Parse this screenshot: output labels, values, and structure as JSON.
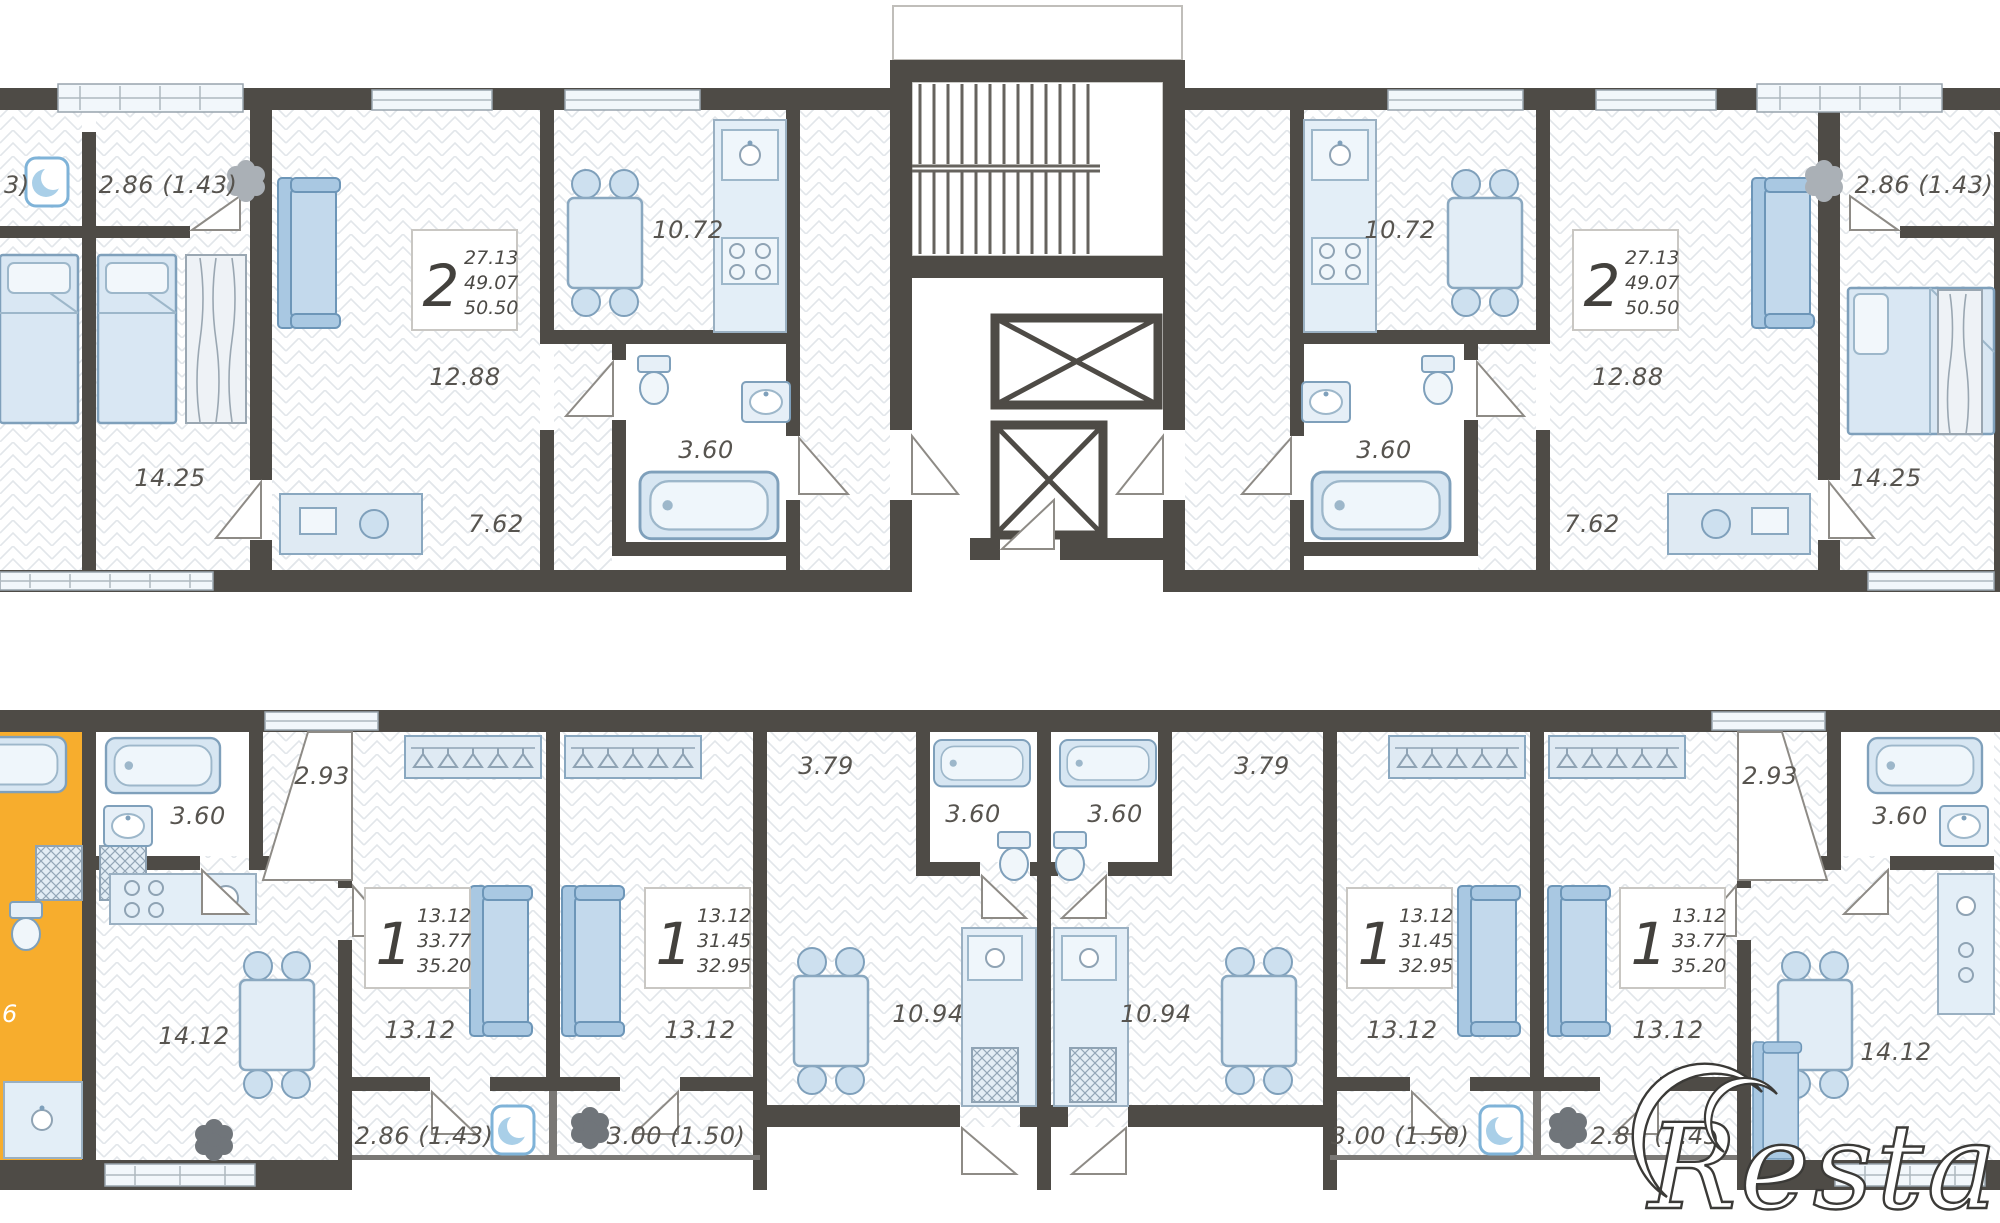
{
  "watermark": "Restate",
  "colors": {
    "wall": "#4e4b46",
    "highlight_orange": "#f7ad2d",
    "furniture_blue": "#d7e6f2",
    "label_gray": "#57544f"
  },
  "upper": {
    "edge_balcony_partial": "3)",
    "left": {
      "type": "2",
      "area_living": "27.13",
      "area_main": "49.07",
      "area_total": "50.50",
      "balcony": "2.86 (1.43)",
      "bedroom": "14.25",
      "living": "12.88",
      "kitchen": "10.72",
      "bath": "3.60",
      "hall": "7.62"
    },
    "right": {
      "type": "2",
      "area_living": "27.13",
      "area_main": "49.07",
      "area_total": "50.50",
      "balcony": "2.86 (1.43)",
      "bedroom": "14.25",
      "living": "12.88",
      "kitchen": "10.72",
      "bath": "3.60",
      "hall": "7.62"
    }
  },
  "lower": {
    "highlighted_partial": "6",
    "left_corner": {
      "bath": "3.60",
      "loggia": "2.93",
      "kitchen_living": "14.12"
    },
    "one_room_a_left": {
      "type": "1",
      "area_living": "13.12",
      "area_main": "33.77",
      "area_total": "35.20",
      "room": "13.12",
      "balcony": "2.86 (1.43)"
    },
    "one_room_b_left": {
      "type": "1",
      "area_living": "13.12",
      "area_main": "31.45",
      "area_total": "32.95",
      "room": "13.12",
      "balcony": "3.00 (1.50)"
    },
    "studio_left": {
      "bath": "3.60",
      "hall": "3.79",
      "kitchen": "10.94"
    },
    "studio_right": {
      "bath": "3.60",
      "hall": "3.79",
      "kitchen": "10.94"
    },
    "one_room_b_right": {
      "type": "1",
      "area_living": "13.12",
      "area_main": "31.45",
      "area_total": "32.95",
      "room": "13.12",
      "balcony": "3.00 (1.50)"
    },
    "one_room_a_right": {
      "type": "1",
      "area_living": "13.12",
      "area_main": "33.77",
      "area_total": "35.20",
      "room": "13.12",
      "balcony": "2.86 (1.43)"
    },
    "right_corner": {
      "bath": "3.60",
      "loggia": "2.93",
      "kitchen_living": "14.12"
    }
  }
}
